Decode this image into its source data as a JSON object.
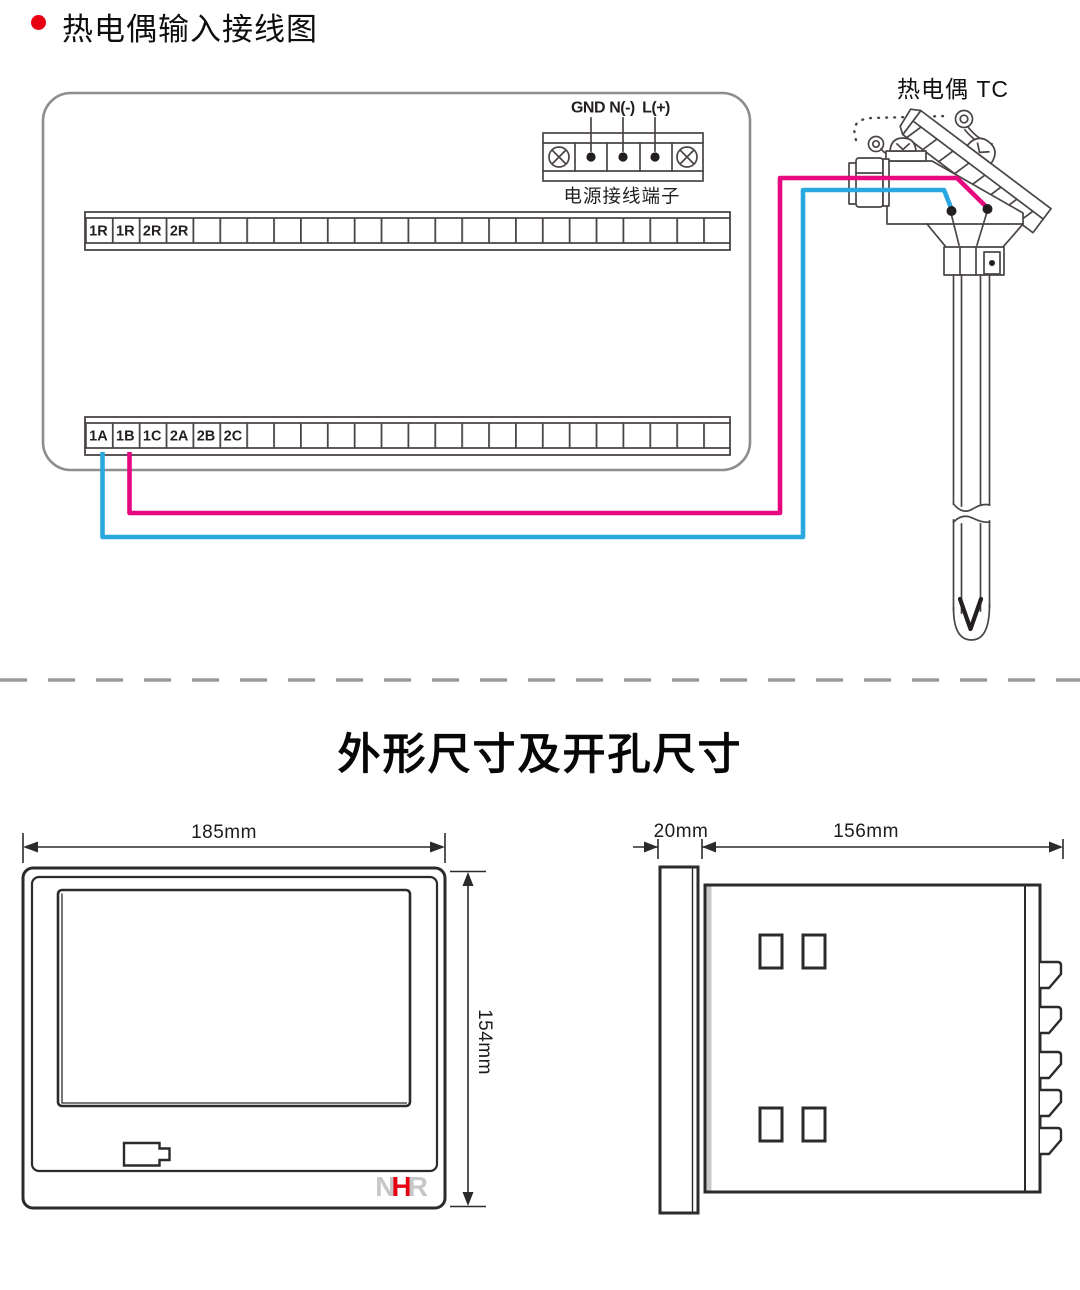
{
  "header": {
    "title": "热电偶输入接线图"
  },
  "wiring": {
    "power_block": {
      "labels": [
        "GND",
        "N(-)",
        "L(+)"
      ],
      "caption": "电源接线端子"
    },
    "strip_top_cells": [
      "1R",
      "1R",
      "2R",
      "2R"
    ],
    "strip_bottom_cells": [
      "1A",
      "1B",
      "1C",
      "2A",
      "2B",
      "2C"
    ],
    "tc_label": "热电偶 TC",
    "colors": {
      "wire_positive": "#e5087e",
      "wire_negative": "#29a8e0",
      "panel_outline": "#8d8d8d",
      "line_art": "#4a4445"
    }
  },
  "dimensions_section": {
    "title": "外形尺寸及开孔尺寸",
    "front_view": {
      "width": "185mm",
      "height": "154mm"
    },
    "side_view": {
      "depth": "20mm",
      "length": "156mm"
    },
    "logo": {
      "letters": [
        "N",
        "H",
        "R"
      ],
      "h_color": "#e60012",
      "nr_color": "#c6c7c9"
    }
  }
}
